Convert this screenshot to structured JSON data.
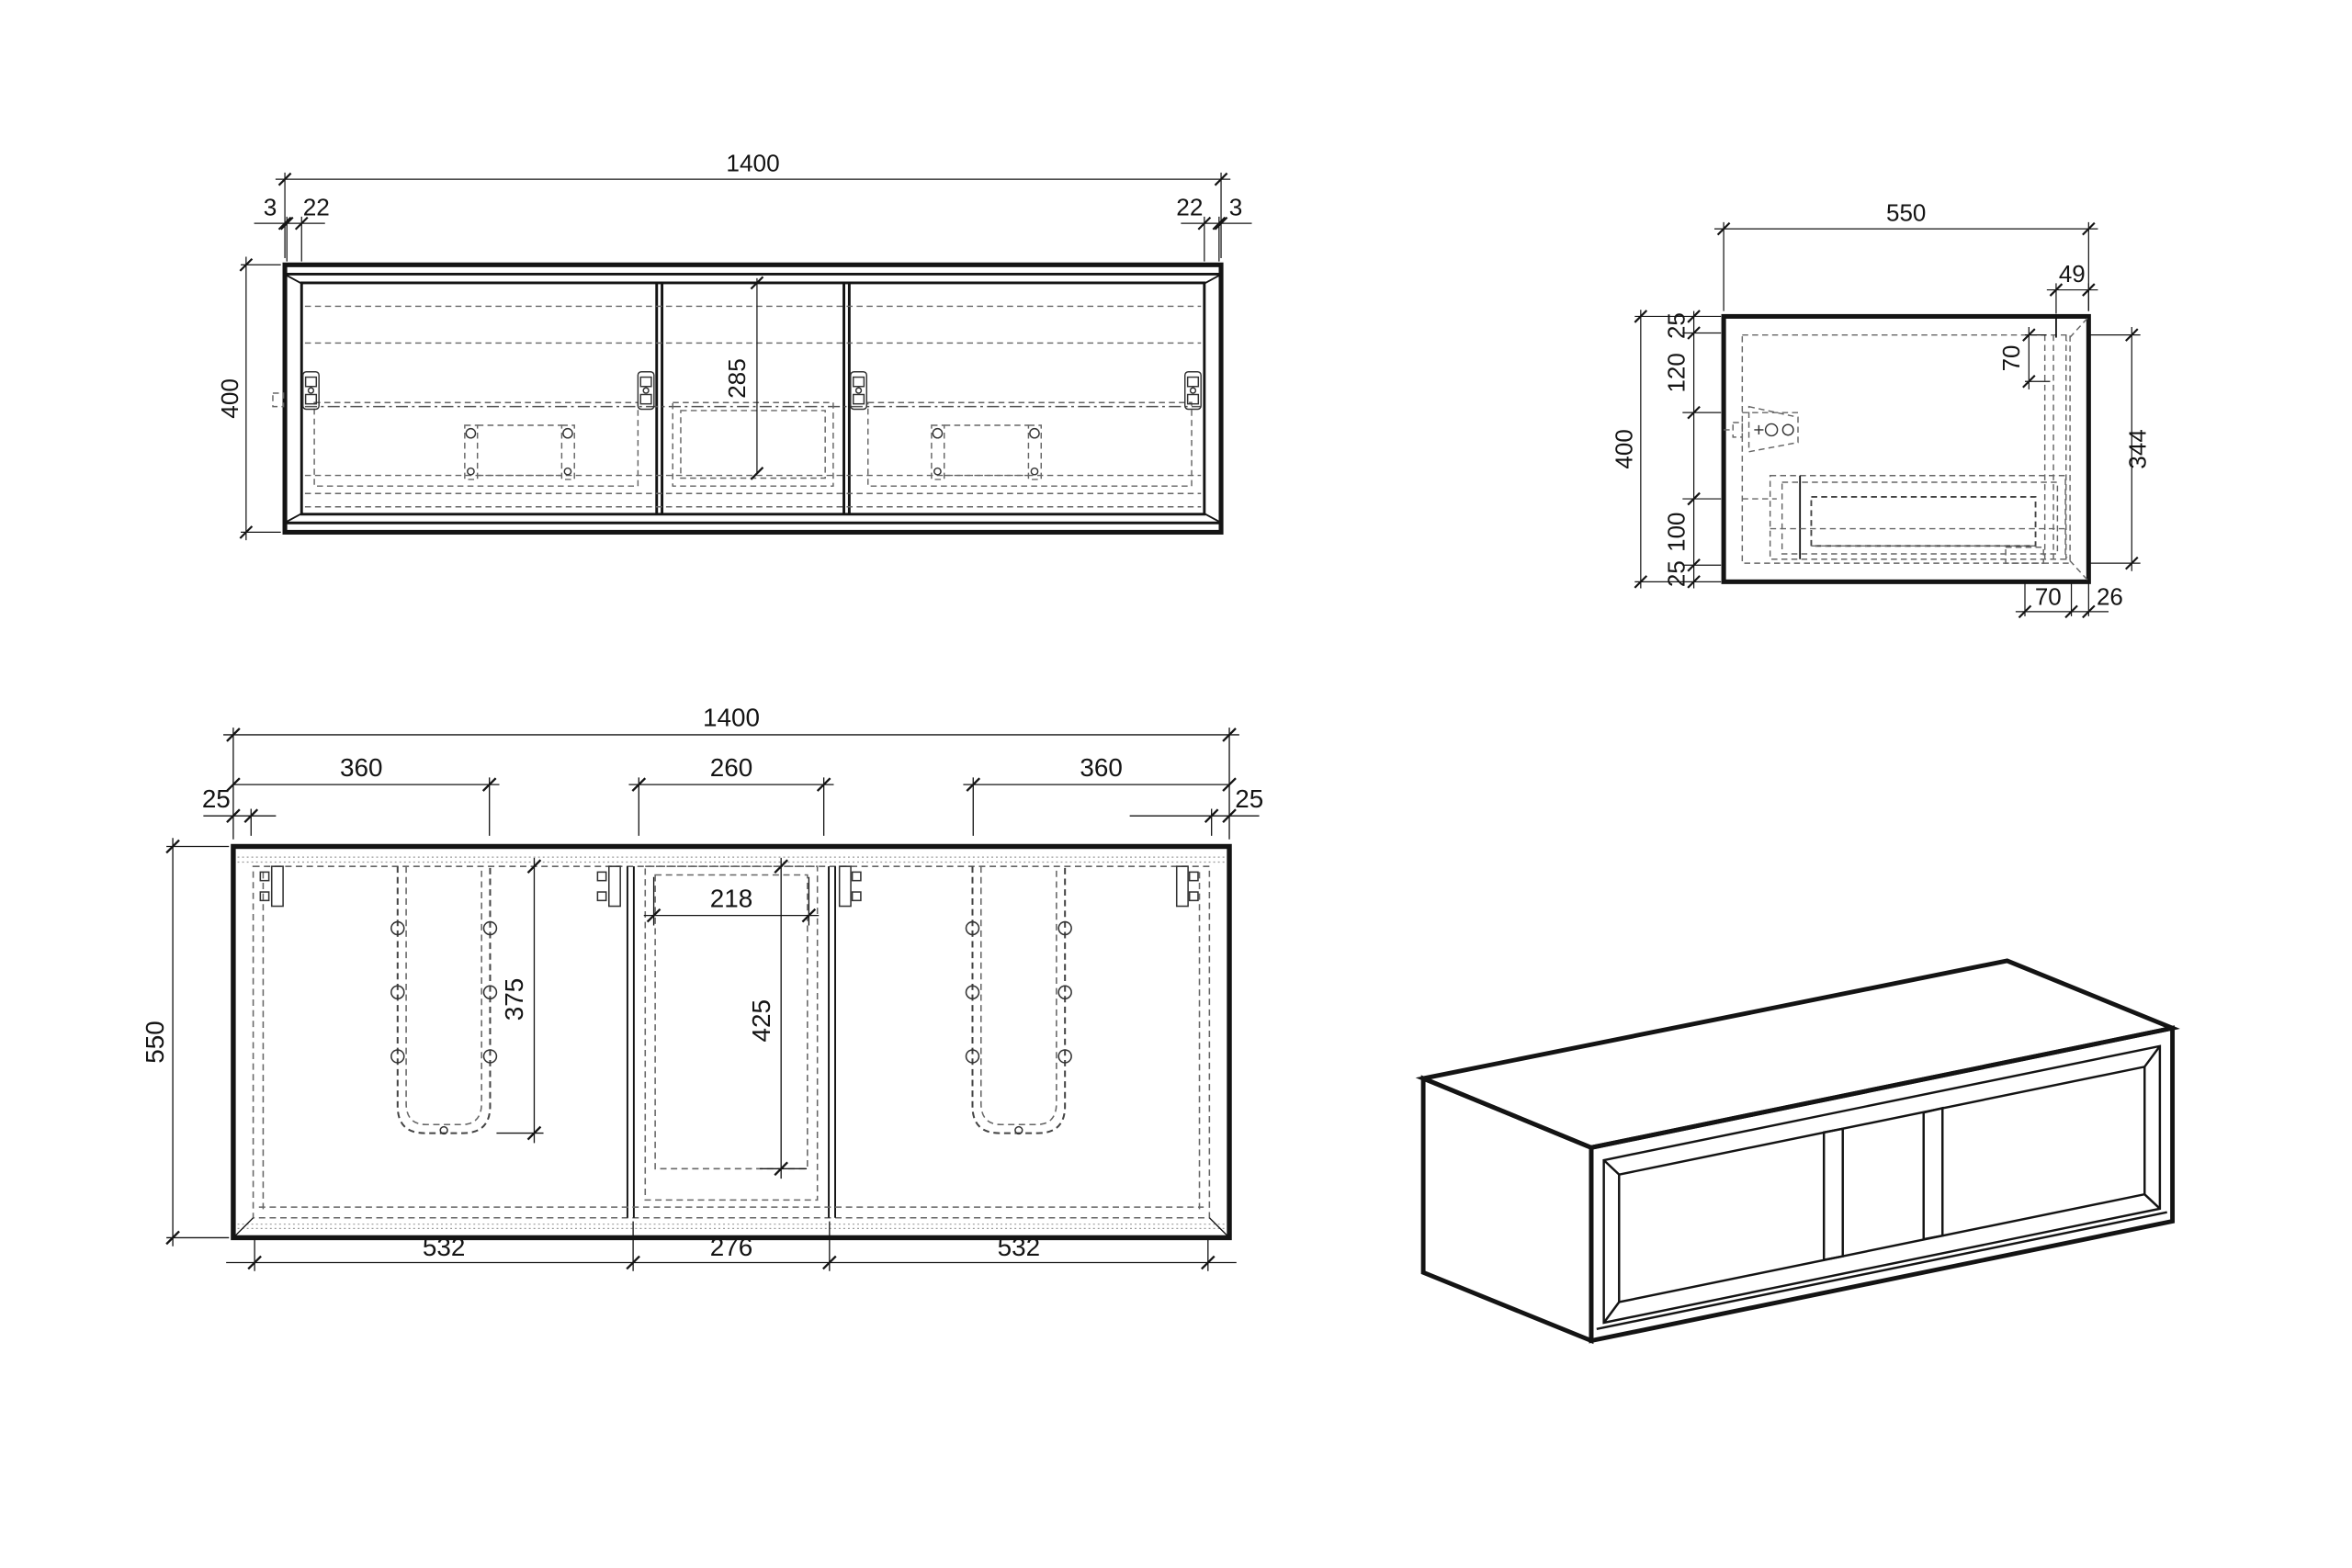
{
  "views": {
    "front": {
      "dims": {
        "width": "1400",
        "left_edge": "3",
        "left_frame": "22",
        "right_frame": "22",
        "right_edge": "3",
        "height": "400",
        "opening_drop": "285"
      }
    },
    "side": {
      "dims": {
        "depth": "550",
        "top_thickness": "25",
        "hinge_drop": "120",
        "height": "400",
        "lower_section": "100",
        "bottom_thickness": "25",
        "front_inset": "49",
        "top_rail": "70",
        "inner_face": "344",
        "bottom_rail": "70",
        "door_thickness": "26"
      }
    },
    "plan": {
      "dims": {
        "width": "1400",
        "left_door": "360",
        "middle_door": "260",
        "right_door": "360",
        "left_reveal": "25",
        "right_reveal": "25",
        "depth": "550",
        "middle_opening": "218",
        "sink_cutout_depth": "375",
        "middle_depth": "425",
        "left_bay": "532",
        "middle_bay": "276",
        "right_bay": "532"
      }
    }
  }
}
